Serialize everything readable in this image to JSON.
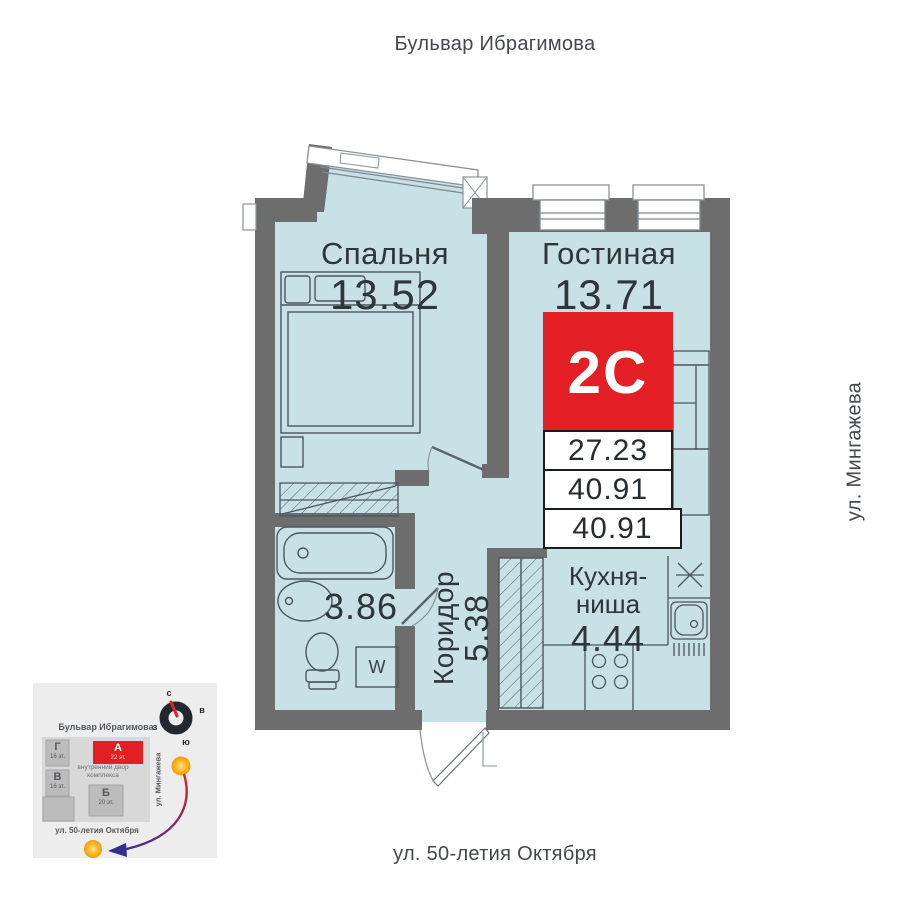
{
  "streets": {
    "top": "Бульвар Ибрагимова",
    "right": "ул. Мингажева",
    "bottom": "ул. 50-летия Октября"
  },
  "plan": {
    "badge": "2С",
    "area_rows": [
      "27.23",
      "40.91",
      "40.91"
    ],
    "bedroom": {
      "name": "Спальня",
      "area": "13.52"
    },
    "living": {
      "name": "Гостиная",
      "area": "13.71"
    },
    "bathroom": {
      "area": "3.86"
    },
    "corridor": {
      "name": "Коридор",
      "area": "5.38"
    },
    "kitchen": {
      "name_line1": "Кухня-",
      "name_line2": "ниша",
      "area": "4.44"
    },
    "washer": "W"
  },
  "minimap": {
    "street_top": "Бульвар Ибрагимова",
    "street_right": "ул. Мингажева",
    "street_bottom": "ул. 50-летия Октября",
    "courtyard_line1": "внутренний двор",
    "courtyard_line2": "комплекса",
    "compass": {
      "north": "с",
      "south": "ю",
      "east": "в",
      "west": "з"
    },
    "buildings": [
      {
        "label": "Г",
        "floors": "16 эт."
      },
      {
        "label": "В",
        "floors": "16 эт."
      },
      {
        "label": "А",
        "floors": "22 эт."
      },
      {
        "label": "Б",
        "floors": "20 эт."
      }
    ]
  },
  "colors": {
    "accent": "#e31e24",
    "room_fill": "#c8e1e7",
    "wall": "#6d6d6d",
    "compass_ring": "#23282e",
    "arrow_start": "#d9252b",
    "arrow_end": "#2f2f8f"
  }
}
